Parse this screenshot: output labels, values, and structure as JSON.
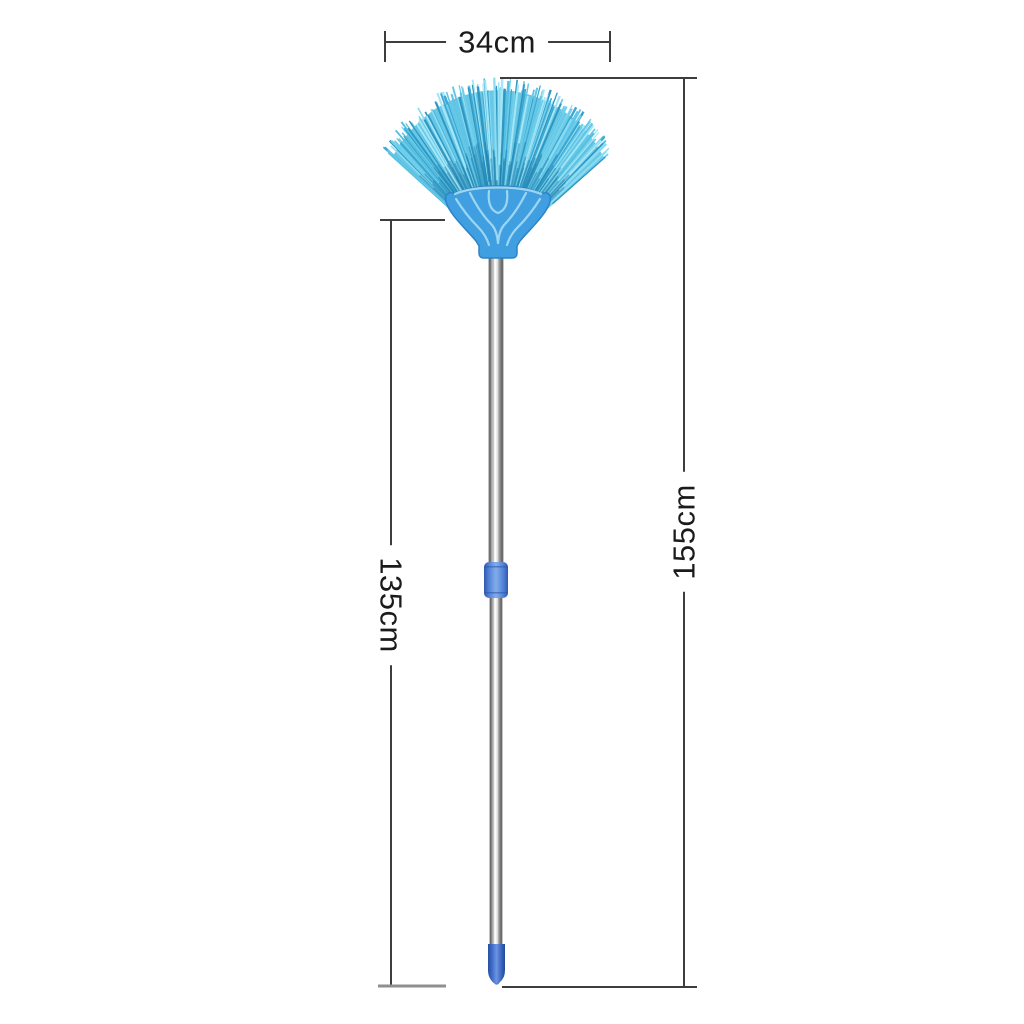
{
  "product_diagram": {
    "subject": "fan-head broom with telescopic pole",
    "measurements": {
      "head_width": "34cm",
      "total_height": "155cm",
      "handle_height": "135cm"
    },
    "line_color": "#3d3d3d",
    "line_color_light": "#8f8f8f",
    "text_color": "#1b1b1b",
    "background_color": "#ffffff"
  },
  "broom": {
    "colors": {
      "bristle_base": "#68c8e6",
      "bristle_palette": [
        "#3da8d2",
        "#55bfe2",
        "#6fcfeb",
        "#8adcf2",
        "#a5e6f6",
        "#2f97c2",
        "#62c6e6"
      ],
      "bristle_root": "#1f7fae",
      "head": "#3f9fe0",
      "head_edge": "#2c84c8",
      "head_pattern": "#a8dcf5",
      "pole_chrome_light": "#ffffff",
      "pole_chrome_dark": "#606060",
      "grip_collar": "#5585da",
      "tip_cap": "#3f6ecb"
    }
  }
}
